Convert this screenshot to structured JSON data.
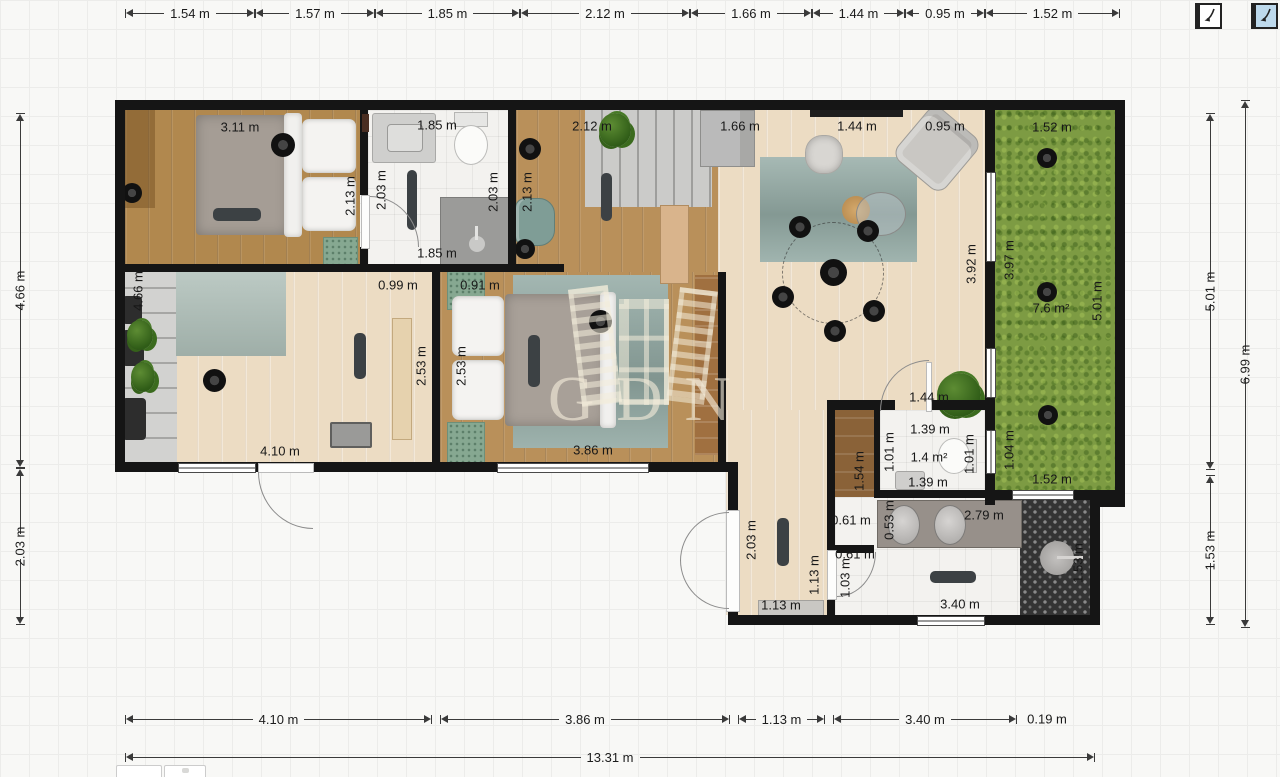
{
  "watermark": {
    "text": "GDN"
  },
  "toolbar": {
    "icons": [
      {
        "name": "mirror-plan-icon",
        "bg": "#ffffff",
        "selected": false
      },
      {
        "name": "mirror-plan-icon-active",
        "bg": "#bdd9ec",
        "selected": true
      }
    ]
  },
  "dimensions": {
    "exterior": [
      {
        "text": "1.54 m",
        "orient": "h",
        "x": 125,
        "y": 13,
        "len": 130
      },
      {
        "text": "1.57 m",
        "orient": "h",
        "x": 255,
        "y": 13,
        "len": 120
      },
      {
        "text": "1.85 m",
        "orient": "h",
        "x": 375,
        "y": 13,
        "len": 145
      },
      {
        "text": "2.12 m",
        "orient": "h",
        "x": 520,
        "y": 13,
        "len": 170
      },
      {
        "text": "1.66 m",
        "orient": "h",
        "x": 690,
        "y": 13,
        "len": 122
      },
      {
        "text": "1.44 m",
        "orient": "h",
        "x": 812,
        "y": 13,
        "len": 93
      },
      {
        "text": "0.95 m",
        "orient": "h",
        "x": 905,
        "y": 13,
        "len": 80
      },
      {
        "text": "1.52 m",
        "orient": "h",
        "x": 985,
        "y": 13,
        "len": 135
      },
      {
        "text": "4.10 m",
        "orient": "h",
        "x": 125,
        "y": 719,
        "len": 307
      },
      {
        "text": "3.86 m",
        "orient": "h",
        "x": 440,
        "y": 719,
        "len": 290
      },
      {
        "text": "1.13 m",
        "orient": "h",
        "x": 738,
        "y": 719,
        "len": 87
      },
      {
        "text": "3.40 m",
        "orient": "h",
        "x": 833,
        "y": 719,
        "len": 184
      },
      {
        "text": "13.31 m",
        "orient": "h",
        "x": 125,
        "y": 757,
        "len": 970
      },
      {
        "text": "4.66 m",
        "orient": "v",
        "x": 20,
        "y": 113,
        "len": 355
      },
      {
        "text": "2.03 m",
        "orient": "v",
        "x": 20,
        "y": 468,
        "len": 157
      },
      {
        "text": "5.01 m",
        "orient": "v",
        "x": 1210,
        "y": 113,
        "len": 357
      },
      {
        "text": "1.53 m",
        "orient": "v",
        "x": 1210,
        "y": 475,
        "len": 150
      },
      {
        "text": "6.99 m",
        "orient": "v",
        "x": 1245,
        "y": 100,
        "len": 528
      }
    ],
    "interior": [
      {
        "text": "3.11 m",
        "x": 240,
        "y": 127
      },
      {
        "text": "2.13 m",
        "x": 350,
        "y": 196,
        "rot": -90
      },
      {
        "text": "1.85 m",
        "x": 437,
        "y": 125
      },
      {
        "text": "2.03 m",
        "x": 381,
        "y": 190,
        "rot": -90
      },
      {
        "text": "1.85 m",
        "x": 437,
        "y": 253
      },
      {
        "text": "2.03 m",
        "x": 493,
        "y": 192,
        "rot": -90
      },
      {
        "text": "2.12 m",
        "x": 592,
        "y": 126
      },
      {
        "text": "2.13 m",
        "x": 527,
        "y": 192,
        "rot": -90
      },
      {
        "text": "1.66 m",
        "x": 740,
        "y": 126
      },
      {
        "text": "1.44 m",
        "x": 857,
        "y": 126
      },
      {
        "text": "0.95 m",
        "x": 945,
        "y": 126
      },
      {
        "text": "1.52 m",
        "x": 1052,
        "y": 127
      },
      {
        "text": "3.92 m",
        "x": 971,
        "y": 264,
        "rot": -90
      },
      {
        "text": "3.97 m",
        "x": 1009,
        "y": 260,
        "rot": -90
      },
      {
        "text": "7.6 m²",
        "x": 1051,
        "y": 308
      },
      {
        "text": "5.01 m",
        "x": 1097,
        "y": 301,
        "rot": -90
      },
      {
        "text": "1.04 m",
        "x": 1009,
        "y": 450,
        "rot": -90
      },
      {
        "text": "1.52 m",
        "x": 1052,
        "y": 479
      },
      {
        "text": "4.66 m",
        "x": 138,
        "y": 291,
        "rot": -90
      },
      {
        "text": "0.99 m",
        "x": 398,
        "y": 285
      },
      {
        "text": "0.91 m",
        "x": 480,
        "y": 285
      },
      {
        "text": "2.53 m",
        "x": 421,
        "y": 366,
        "rot": -90
      },
      {
        "text": "2.53 m",
        "x": 461,
        "y": 366,
        "rot": -90
      },
      {
        "text": "4.10 m",
        "x": 280,
        "y": 451
      },
      {
        "text": "3.86 m",
        "x": 593,
        "y": 450
      },
      {
        "text": "1.44 m",
        "x": 929,
        "y": 397
      },
      {
        "text": "1.39 m",
        "x": 930,
        "y": 429
      },
      {
        "text": "1.01 m",
        "x": 889,
        "y": 452,
        "rot": -90
      },
      {
        "text": "1.4 m²",
        "x": 929,
        "y": 457
      },
      {
        "text": "1.01 m",
        "x": 969,
        "y": 454,
        "rot": -90
      },
      {
        "text": "1.39 m",
        "x": 928,
        "y": 482
      },
      {
        "text": "1.54 m",
        "x": 859,
        "y": 471,
        "rot": -90
      },
      {
        "text": "0.61 m",
        "x": 851,
        "y": 520
      },
      {
        "text": "0.53 m",
        "x": 889,
        "y": 520,
        "rot": -90
      },
      {
        "text": "2.79 m",
        "x": 984,
        "y": 515
      },
      {
        "text": "0.61 m",
        "x": 855,
        "y": 554
      },
      {
        "text": "1.03 m",
        "x": 845,
        "y": 578,
        "rot": -90
      },
      {
        "text": "3.40 m",
        "x": 960,
        "y": 604
      },
      {
        "text": "1.53 m",
        "x": 1078,
        "y": 563,
        "rot": -90
      },
      {
        "text": "2.03 m",
        "x": 751,
        "y": 540,
        "rot": -90
      },
      {
        "text": "1.13 m",
        "x": 814,
        "y": 575,
        "rot": -90
      },
      {
        "text": "1.13 m",
        "x": 781,
        "y": 605
      },
      {
        "text": "0.19 m",
        "x": 1047,
        "y": 719
      }
    ]
  }
}
